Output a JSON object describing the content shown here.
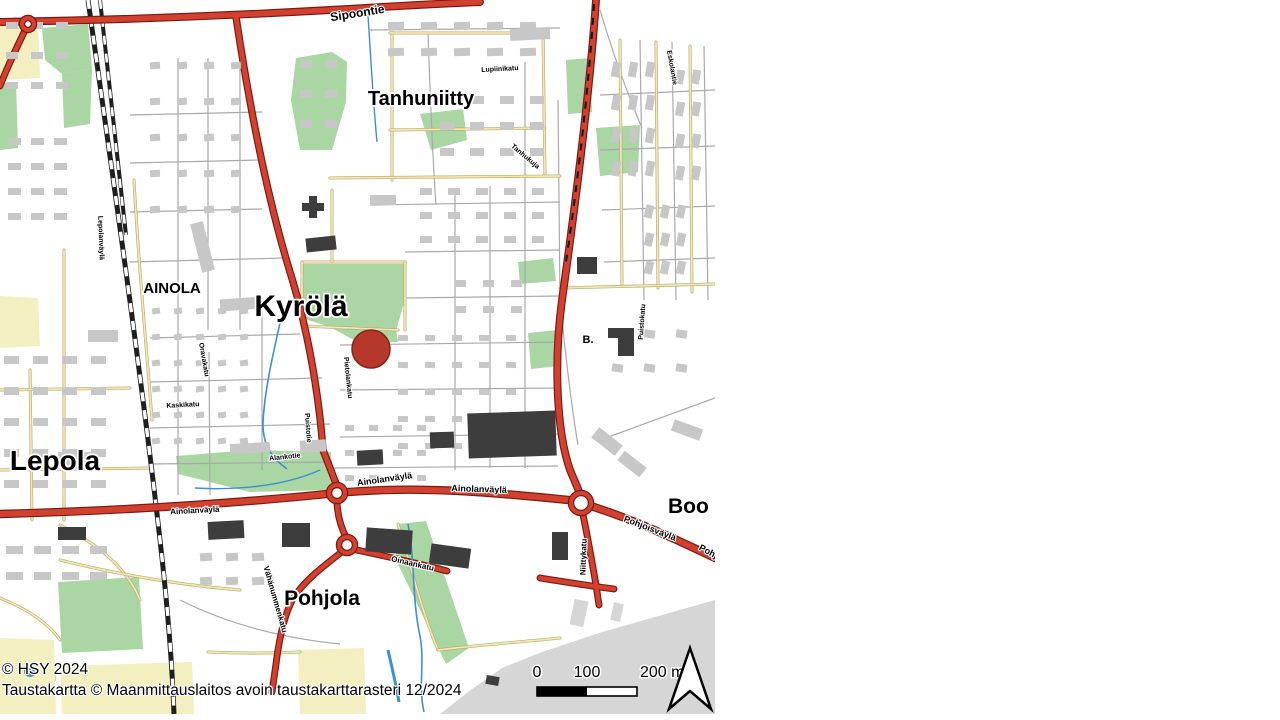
{
  "attribution": {
    "line1": "© HSY 2024",
    "line2": "Taustakartta © Maanmittauslaitos avoin taustakarttarasteri 12/2024"
  },
  "scalebar": {
    "labels": [
      "0",
      "100",
      "200 m"
    ],
    "bar_x": 537,
    "bar_y": 687,
    "seg_w": 50,
    "bar_h": 9,
    "label_y": 677
  },
  "marker": {
    "x": 371,
    "y": 349,
    "r": 19,
    "fill": "#b5382a",
    "stroke": "#8a2218"
  },
  "colors": {
    "park": "#a9d6a2",
    "yellow_area": "#f3efc0",
    "gray_area": "#d6d6d6",
    "building": "#c7c7c7",
    "building_dark": "#3d3d3d",
    "road_red": "#d2402f",
    "road_red_casing": "#7c1a10",
    "road_yellow": "#f4e9a6",
    "road_yellow_casing": "#b4aa80",
    "road_gray": "#a9a9a9",
    "rail": "#1f1f1f",
    "water": "#3e8ed0"
  },
  "place_labels": [
    {
      "text": "Tanhuniitty",
      "x": 421,
      "y": 105,
      "size": 20,
      "rot": 0
    },
    {
      "text": "Kyrölä",
      "x": 301,
      "y": 316,
      "size": 30,
      "rot": 0
    },
    {
      "text": "AINOLA",
      "x": 172,
      "y": 293,
      "size": 15,
      "rot": 0
    },
    {
      "text": "Lepola",
      "x": 55,
      "y": 470,
      "size": 28,
      "rot": 0
    },
    {
      "text": "Pohjola",
      "x": 322,
      "y": 605,
      "size": 21,
      "rot": 0
    },
    {
      "text": "Boo",
      "x": 668,
      "y": 513,
      "size": 21,
      "rot": 0,
      "anchor": "start"
    },
    {
      "text": "B.",
      "x": 588,
      "y": 343,
      "size": 11,
      "rot": 0
    }
  ],
  "street_labels": [
    {
      "text": "Sipoontie",
      "x": 358,
      "y": 17,
      "rot": -9,
      "size": 12
    },
    {
      "text": "Lupiinikatu",
      "x": 500,
      "y": 71,
      "rot": -3,
      "size": 7
    },
    {
      "text": "Tanhukuja",
      "x": 524,
      "y": 158,
      "rot": 40,
      "size": 7
    },
    {
      "text": "Eskolantie",
      "x": 670,
      "y": 68,
      "rot": 80,
      "size": 7
    },
    {
      "text": "Lepolanväylä",
      "x": 99,
      "y": 238,
      "rot": 88,
      "size": 7
    },
    {
      "text": "Oravakatu",
      "x": 202,
      "y": 360,
      "rot": 80,
      "size": 7
    },
    {
      "text": "Pietolankatu",
      "x": 346,
      "y": 378,
      "rot": 84,
      "size": 7
    },
    {
      "text": "Puistotie",
      "x": 306,
      "y": 428,
      "rot": 86,
      "size": 7
    },
    {
      "text": "Kaskikatu",
      "x": 183,
      "y": 407,
      "rot": -3,
      "size": 7
    },
    {
      "text": "Puistokatu",
      "x": 644,
      "y": 322,
      "rot": -86,
      "size": 7
    },
    {
      "text": "Alankotie",
      "x": 285,
      "y": 459,
      "rot": -6,
      "size": 7
    },
    {
      "text": "Ainolanväylä",
      "x": 195,
      "y": 513,
      "rot": -3,
      "size": 8
    },
    {
      "text": "Ainolanväylä",
      "x": 385,
      "y": 482,
      "rot": -8,
      "size": 9
    },
    {
      "text": "Ainolanväylä",
      "x": 479,
      "y": 492,
      "rot": 2,
      "size": 9
    },
    {
      "text": "Pohjoisväylä",
      "x": 649,
      "y": 531,
      "rot": 21,
      "size": 9
    },
    {
      "text": "Pohj",
      "x": 707,
      "y": 554,
      "rot": 28,
      "size": 9
    },
    {
      "text": "Niittykatu",
      "x": 586,
      "y": 557,
      "rot": -88,
      "size": 8
    },
    {
      "text": "Oinaankatu",
      "x": 412,
      "y": 566,
      "rot": 13,
      "size": 8
    },
    {
      "text": "Vähänummenkatu",
      "x": 273,
      "y": 600,
      "rot": 74,
      "size": 8
    }
  ],
  "map": {
    "width": 715,
    "height": 720,
    "parks": [
      {
        "pts": "42,28 88,24 92,68 62,74 45,60"
      },
      {
        "pts": "62,74 92,68 90,124 64,128"
      },
      {
        "pts": "0,84 16,82 18,148 0,150"
      },
      {
        "pts": "296,58 332,52 347,62 346,102 332,150 300,150 291,100"
      },
      {
        "pts": "420,114 463,109 467,140 431,150"
      },
      {
        "pts": "566,60 590,58 592,112 568,114"
      },
      {
        "pts": "596,128 640,125 638,172 600,176"
      },
      {
        "pts": "518,262 553,258 556,281 520,284"
      },
      {
        "pts": "528,333 557,330 559,366 531,369"
      },
      {
        "pts": "302,264 405,264 405,300 396,330 398,342 361,344 330,327 302,318"
      },
      {
        "pts": "176,456 250,450 331,452 333,490 250,492 178,474"
      },
      {
        "pts": "398,524 426,521 469,648 446,664 396,560"
      },
      {
        "pts": "58,582 139,577 143,649 62,653"
      },
      {
        "pts": "14,656 54,653 56,681 16,683"
      }
    ],
    "yellow_areas": [
      {
        "pts": "0,26 38,24 40,78 0,80"
      },
      {
        "pts": "0,296 38,298 40,346 0,348"
      },
      {
        "pts": "0,638 54,640 56,714 0,714"
      },
      {
        "pts": "60,666 192,662 194,714 62,714"
      },
      {
        "pts": "298,650 364,648 366,714 300,714"
      }
    ],
    "gray_areas": [
      {
        "pts": "440,714 468,692 502,668 542,652 602,632 662,615 715,600 715,714"
      }
    ],
    "roads_gray": [
      "M178,58 L178,495",
      "M208,58 L208,330",
      "M240,62 L240,330",
      "M262,300 L262,470",
      "M209,352 L210,495",
      "M130,115 L262,112",
      "M130,163 L262,160",
      "M130,212 L262,209",
      "M130,262 L285,258",
      "M150,338 L300,334",
      "M150,382 L322,378",
      "M150,428 L330,424",
      "M150,464 L332,462",
      "M455,188 L455,470",
      "M490,186 L490,468",
      "M525,62 L525,468",
      "M558,100 L560,300",
      "M370,205 L560,202",
      "M405,252 L560,250",
      "M405,298 L560,296",
      "M340,345 L560,342",
      "M340,390 L560,388",
      "M340,437 L560,434",
      "M332,468 L558,466",
      "M640,40 L644,300",
      "M672,42 L676,300",
      "M704,46 L708,300",
      "M600,95 L715,90",
      "M600,150 L715,146",
      "M602,210 L715,206",
      "M604,262 L715,258",
      "M600,440 L715,398",
      "M180,600 C240,630 300,640 340,644",
      "M370,30 L560,28",
      "M428,32 C430,90 432,150 436,205",
      "M560,300 C566,360 572,410 578,445",
      "M600,10 C615,60 630,100 642,128"
    ],
    "roads_yellow": [
      "M392,30 L392,180",
      "M543,34 L545,176",
      "M390,33 L545,33",
      "M390,130 L545,128",
      "M330,178 L560,176",
      "M302,262 L405,262",
      "M302,262 L302,326",
      "M405,262 L405,330",
      "M302,326 L398,330",
      "M620,40 L622,285",
      "M656,42 L658,288",
      "M690,46 L692,292",
      "M560,288 L715,284",
      "M30,370 L32,520",
      "M64,250 L64,520",
      "M0,390 L130,388",
      "M0,470 L152,468",
      "M134,180 C138,260 146,340 152,420",
      "M60,525 C100,545 128,570 140,600",
      "M0,598 C30,610 50,625 60,640",
      "M398,524 C412,570 422,612 438,650",
      "M438,650 C480,645 520,642 560,638",
      "M208,652 C250,654 278,653 300,652",
      "M332,190 L332,262",
      "M60,560 C120,575 180,585 240,590"
    ],
    "railway": [
      {
        "d": "M88,0 C112,170 142,380 160,540 C168,610 172,660 174,714",
        "w": 5,
        "wd": 3.4
      },
      {
        "d": "M100,0 C108,70 116,150 126,235",
        "w": 4,
        "wd": 2.6
      }
    ],
    "roads_red": [
      {
        "d": "M0,22 C120,20 240,15 330,10 C380,7 430,4 480,2",
        "w": 5.5
      },
      {
        "d": "M28,24 C18,45 8,65 0,86",
        "w": 4.5
      },
      {
        "d": "M236,17 C250,110 268,200 290,272 C308,330 319,395 323,450 L337,486",
        "w": 5
      },
      {
        "d": "M596,0 C590,90 576,200 562,300 C554,360 556,430 570,470 L581,496",
        "w": 5.5
      },
      {
        "d": "M0,514 C110,511 220,505 337,493 C420,485 500,493 578,501",
        "w": 6
      },
      {
        "d": "M581,503 C625,516 665,534 715,558",
        "w": 6
      },
      {
        "d": "M582,510 C588,538 592,562 596,585 L599,605",
        "w": 4.5
      },
      {
        "d": "M337,493 C336,512 341,528 347,539",
        "w": 4.5
      },
      {
        "d": "M352,549 C390,557 420,564 447,571",
        "w": 4.5
      },
      {
        "d": "M540,578 C565,582 590,586 614,589",
        "w": 4.5
      },
      {
        "d": "M343,551 C325,565 305,580 294,597 C284,614 279,640 276,664 L272,692",
        "w": 4.5
      }
    ],
    "red_dashes": [
      {
        "d": "M594,4 C589,85 578,180 566,262",
        "w": 2
      }
    ],
    "water": [
      {
        "d": "M368,16 C371,60 373,100 377,142",
        "w": 1.4
      },
      {
        "d": "M282,314 C272,358 264,394 263,424 C263,446 272,458 287,469",
        "w": 1.6
      },
      {
        "d": "M195,488 C230,490 280,488 320,470",
        "w": 1.4
      },
      {
        "d": "M408,524 C415,560 412,600 420,636 C425,662 418,686 424,712",
        "w": 1.6
      },
      {
        "d": "M388,650 C392,668 396,684 399,702",
        "w": 3
      }
    ],
    "ponds": [
      [
        30,
        671,
        6
      ]
    ],
    "roundabouts": [
      [
        28,
        24,
        6
      ],
      [
        337,
        493,
        8
      ],
      [
        581,
        503,
        10
      ],
      [
        347,
        545,
        8
      ]
    ],
    "buildings": [
      [
        309,
        196,
        8,
        22,
        0,
        "dark"
      ],
      [
        302,
        203,
        22,
        8,
        0,
        "dark"
      ],
      [
        306,
        237,
        30,
        14,
        -6,
        "dark"
      ],
      [
        577,
        257,
        20,
        17,
        0,
        "dark"
      ],
      [
        608,
        328,
        26,
        10,
        0,
        "dark"
      ],
      [
        618,
        334,
        16,
        22,
        0,
        "dark"
      ],
      [
        468,
        412,
        88,
        45,
        -2,
        "dark"
      ],
      [
        430,
        432,
        24,
        16,
        -2,
        "dark"
      ],
      [
        357,
        450,
        26,
        15,
        -3,
        "dark"
      ],
      [
        366,
        529,
        46,
        24,
        4,
        "dark"
      ],
      [
        430,
        546,
        40,
        20,
        8,
        "dark"
      ],
      [
        282,
        523,
        28,
        24,
        0,
        "dark"
      ],
      [
        208,
        521,
        36,
        18,
        -3,
        "dark"
      ],
      [
        58,
        527,
        28,
        13,
        0,
        "dark"
      ],
      [
        486,
        676,
        13,
        9,
        10,
        "dark"
      ],
      [
        552,
        532,
        16,
        28,
        0,
        "dark"
      ],
      [
        196,
        222,
        13,
        50,
        -14,
        "light"
      ],
      [
        220,
        298,
        42,
        12,
        -4,
        "light"
      ],
      [
        88,
        330,
        30,
        12,
        0,
        "light"
      ],
      [
        58,
        452,
        34,
        13,
        0,
        "light"
      ],
      [
        510,
        28,
        40,
        12,
        -3,
        "light"
      ],
      [
        370,
        195,
        26,
        10,
        0,
        "light"
      ],
      [
        230,
        443,
        40,
        10,
        -3,
        "light"
      ],
      [
        300,
        440,
        26,
        12,
        -3,
        "light"
      ],
      [
        592,
        435,
        30,
        13,
        38,
        "light"
      ],
      [
        618,
        458,
        28,
        12,
        38,
        "light"
      ],
      [
        672,
        424,
        30,
        12,
        20,
        "light"
      ],
      [
        572,
        600,
        14,
        26,
        12,
        "blob"
      ],
      [
        612,
        603,
        10,
        18,
        12,
        "blob"
      ]
    ],
    "building_clusters": [
      {
        "x": 388,
        "y": 22,
        "cols": 5,
        "rows": 2,
        "w": 16,
        "h": 8,
        "dx": 33,
        "dy": 26,
        "rot": -2
      },
      {
        "x": 440,
        "y": 96,
        "cols": 4,
        "rows": 3,
        "w": 14,
        "h": 8,
        "dx": 30,
        "dy": 26,
        "rot": 0
      },
      {
        "x": 612,
        "y": 62,
        "cols": 3,
        "rows": 4,
        "w": 8,
        "h": 15,
        "dx": 17,
        "dy": 33,
        "rot": 10
      },
      {
        "x": 676,
        "y": 70,
        "cols": 2,
        "rows": 4,
        "w": 8,
        "h": 14,
        "dx": 16,
        "dy": 32,
        "rot": 10
      },
      {
        "x": 645,
        "y": 205,
        "cols": 3,
        "rows": 3,
        "w": 8,
        "h": 13,
        "dx": 16,
        "dy": 28,
        "rot": 12
      },
      {
        "x": 150,
        "y": 62,
        "cols": 4,
        "rows": 5,
        "w": 10,
        "h": 7,
        "dx": 27,
        "dy": 36,
        "rot": -4
      },
      {
        "x": 8,
        "y": 138,
        "cols": 3,
        "rows": 4,
        "w": 13,
        "h": 7,
        "dx": 23,
        "dy": 25,
        "rot": 0
      },
      {
        "x": 152,
        "y": 308,
        "cols": 5,
        "rows": 6,
        "w": 8,
        "h": 6,
        "dx": 22,
        "dy": 26,
        "rot": -8
      },
      {
        "x": 4,
        "y": 356,
        "cols": 4,
        "rows": 5,
        "w": 15,
        "h": 8,
        "dx": 29,
        "dy": 31,
        "rot": 0
      },
      {
        "x": 420,
        "y": 188,
        "cols": 5,
        "rows": 3,
        "w": 12,
        "h": 7,
        "dx": 28,
        "dy": 24,
        "rot": 0
      },
      {
        "x": 398,
        "y": 335,
        "cols": 5,
        "rows": 5,
        "w": 10,
        "h": 6,
        "dx": 27,
        "dy": 27,
        "rot": 2
      },
      {
        "x": 612,
        "y": 330,
        "cols": 3,
        "rows": 2,
        "w": 11,
        "h": 8,
        "dx": 32,
        "dy": 34,
        "rot": 8
      },
      {
        "x": 6,
        "y": 546,
        "cols": 4,
        "rows": 2,
        "w": 17,
        "h": 8,
        "dx": 28,
        "dy": 26,
        "rot": 0
      },
      {
        "x": 345,
        "y": 425,
        "cols": 4,
        "rows": 3,
        "w": 9,
        "h": 6,
        "dx": 24,
        "dy": 25,
        "rot": 2
      },
      {
        "x": 6,
        "y": 22,
        "cols": 3,
        "rows": 3,
        "w": 12,
        "h": 7,
        "dx": 25,
        "dy": 30,
        "rot": 0
      },
      {
        "x": 300,
        "y": 60,
        "cols": 2,
        "rows": 3,
        "w": 12,
        "h": 8,
        "dx": 25,
        "dy": 30,
        "rot": 0
      },
      {
        "x": 455,
        "y": 280,
        "cols": 3,
        "rows": 2,
        "w": 11,
        "h": 7,
        "dx": 28,
        "dy": 26,
        "rot": 0
      },
      {
        "x": 200,
        "y": 553,
        "cols": 3,
        "rows": 2,
        "w": 12,
        "h": 8,
        "dx": 26,
        "dy": 24,
        "rot": -4
      }
    ]
  }
}
